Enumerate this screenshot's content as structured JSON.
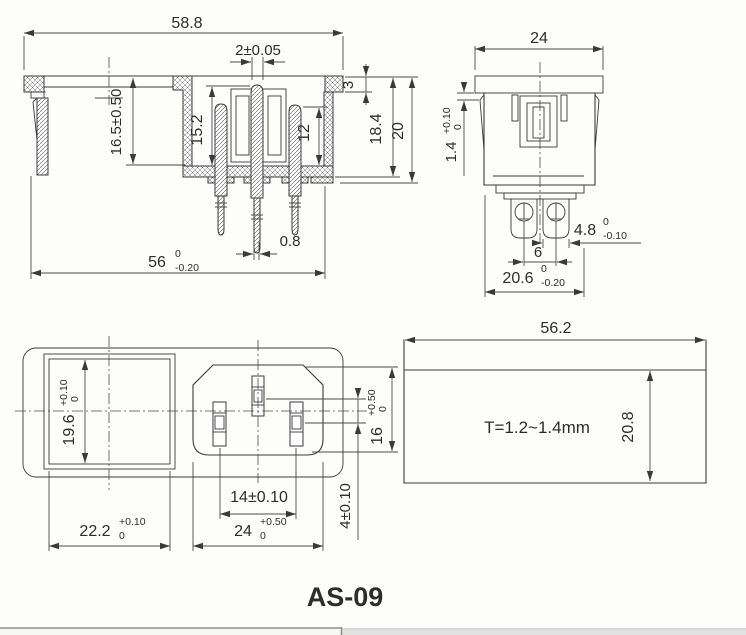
{
  "title": "AS-09",
  "views": {
    "side_section": {
      "dims": {
        "overall_width": {
          "v": "58.8"
        },
        "pin_width_top": {
          "v": "2±0.05"
        },
        "flange_thickness": {
          "v": "3"
        },
        "body_depth": {
          "v": "18.4"
        },
        "total_depth": {
          "v": "20"
        },
        "pin_height_center": {
          "v": "15.2"
        },
        "pin_height_right": {
          "v": "12"
        },
        "mount_depth": {
          "v": "16.5±0.50"
        },
        "pin_tip_width": {
          "v": "0.8"
        },
        "body_width": {
          "v": "56",
          "up": "0",
          "dn": "-0.20"
        }
      }
    },
    "front_section": {
      "dims": {
        "flange_width": {
          "v": "24"
        },
        "latch_gap": {
          "v": "1.4",
          "up": "+0.10",
          "dn": "0"
        },
        "terminal_width": {
          "v": "4.8",
          "up": "0",
          "dn": "-0.10"
        },
        "terminal_pitch": {
          "v": "6"
        },
        "body_width": {
          "v": "20.6",
          "up": "0",
          "dn": "-0.20"
        }
      }
    },
    "face_view": {
      "dims": {
        "switch_hole_height": {
          "v": "19.6",
          "up": "+0.10",
          "dn": "0"
        },
        "switch_hole_width": {
          "v": "22.2",
          "up": "+0.10",
          "dn": "0"
        },
        "pin_pitch": {
          "v": "14±0.10"
        },
        "inlet_width": {
          "v": "24",
          "up": "+0.50",
          "dn": "0"
        },
        "inlet_height": {
          "v": "16",
          "up": "+0.50",
          "dn": "0"
        },
        "earth_pin_offset": {
          "v": "4±0.10"
        }
      }
    },
    "panel_cutout": {
      "dims": {
        "cutout_width": {
          "v": "56.2"
        },
        "cutout_height": {
          "v": "20.8"
        }
      },
      "note": {
        "panel_thickness": {
          "v": "T=1.2~1.4mm"
        }
      }
    }
  }
}
